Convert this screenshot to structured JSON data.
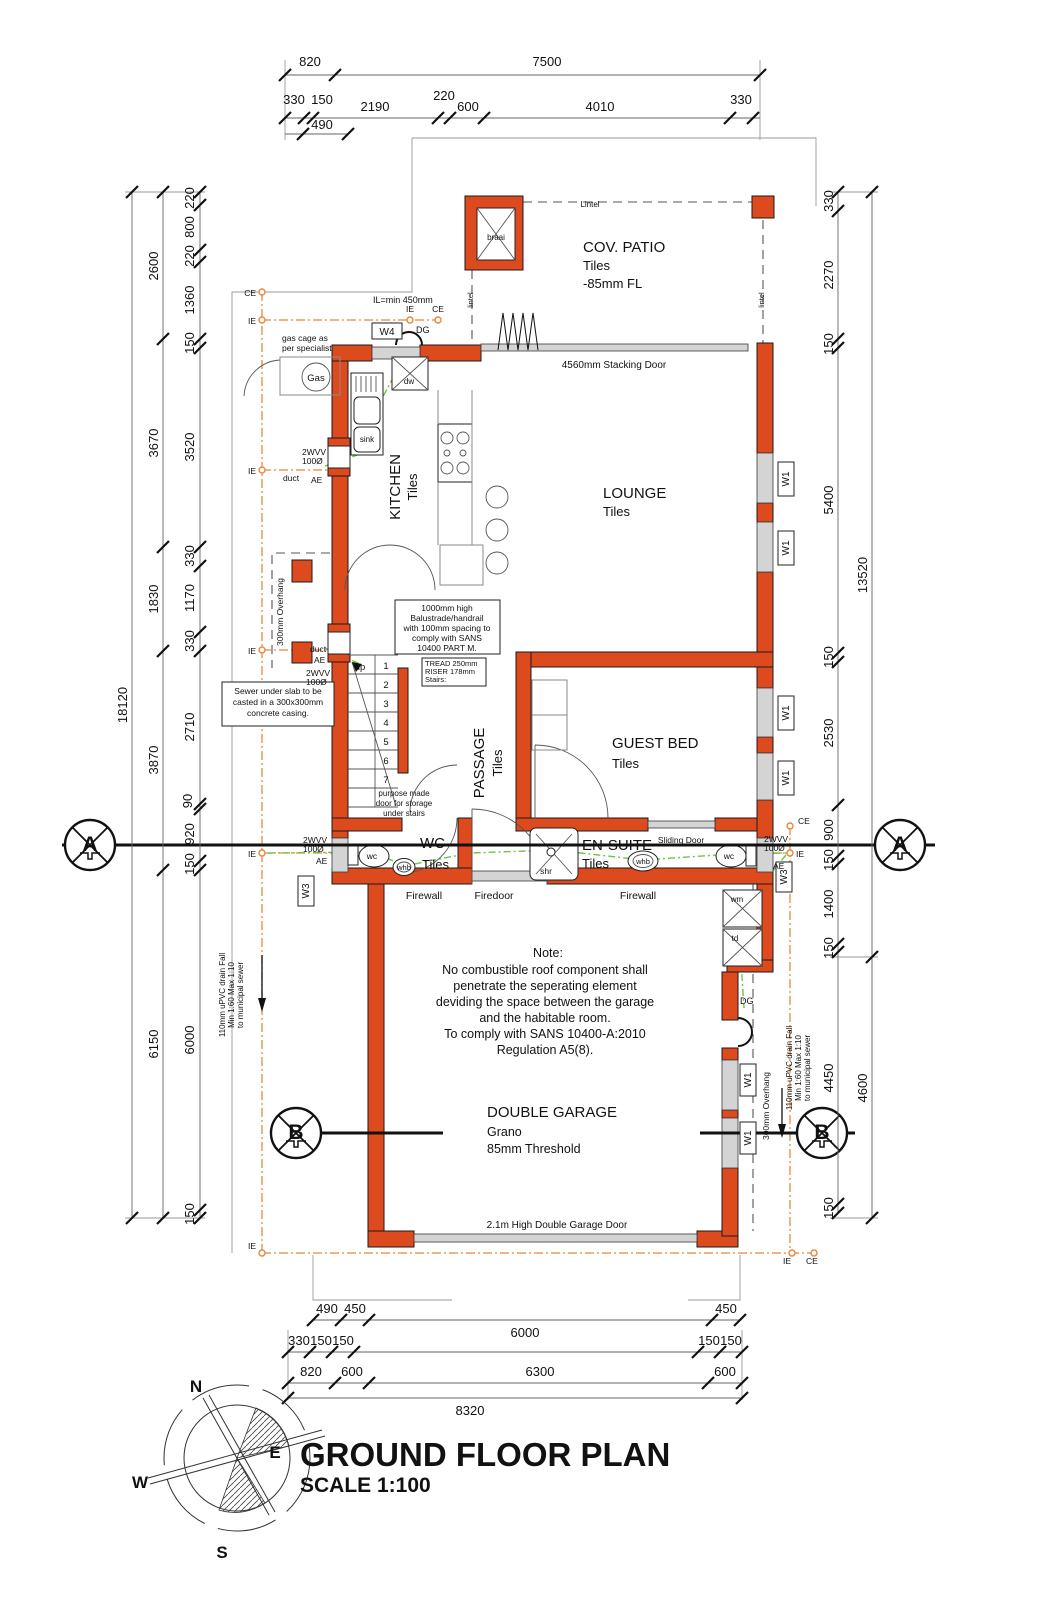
{
  "title": {
    "main": "GROUND FLOOR PLAN",
    "scale": "SCALE 1:100"
  },
  "compass": {
    "n": "N",
    "e": "E",
    "w": "W",
    "s": "S"
  },
  "rooms": {
    "patio": {
      "name": "COV. PATIO",
      "finish": "Tiles",
      "level": "-85mm FL"
    },
    "lounge": {
      "name": "LOUNGE",
      "finish": "Tiles"
    },
    "kitchen": {
      "name": "KITCHEN",
      "finish": "Tiles"
    },
    "passage": {
      "name": "PASSAGE",
      "finish": "Tiles"
    },
    "guest_bed": {
      "name": "GUEST BED",
      "finish": "Tiles"
    },
    "wc": {
      "name": "WC",
      "finish": "Tiles"
    },
    "ensuite": {
      "name": "EN-SUITE",
      "finish": "Tiles"
    },
    "garage": {
      "name": "DOUBLE GARAGE",
      "finish": "Grano",
      "threshold": "85mm Threshold"
    }
  },
  "doors": {
    "stacking": "4560mm Stacking Door",
    "garage": "2.1m High Double Garage Door",
    "sliding": "Sliding Door",
    "firewall_left": "Firewall",
    "firedoor": "Firedoor",
    "firewall_right": "Firewall"
  },
  "notes": {
    "balustrade": [
      "1000mm high",
      "Balustrade/handrail",
      "with 100mm spacing to",
      "comply with SANS",
      "10400 PART M."
    ],
    "stairs": [
      "TREAD 250mm",
      "RISER 178mm",
      "Stairs:"
    ],
    "sewer": [
      "Sewer under slab to be",
      "casted in a 300x300mm",
      "concrete casing."
    ],
    "storage": [
      "purpose made",
      "door for storage",
      "under stairs"
    ],
    "garage_title": "Note:",
    "garage_lines": [
      "No combustible roof component shall",
      "penetrate the seperating element",
      "deviding the space between the garage",
      "and the habitable room.",
      "To comply with SANS 10400-A:2010",
      "Regulation A5(8)."
    ],
    "gas": [
      "gas cage as",
      "per specialist"
    ],
    "il": "IL=min 450mm",
    "drain": [
      "110mm uPVC drain Fall",
      "Min 1:60 Max 1:10",
      "to municipal sewer"
    ],
    "overhang": "300mm Overhang",
    "lintel": "Lintel",
    "lintel_small": "lintel"
  },
  "fixtures": {
    "sink": "sink",
    "dw": "dw",
    "braai": "braai",
    "gas": "Gas",
    "wc": "wc",
    "whb": "whb",
    "shr": "shr",
    "wm": "wm",
    "td": "td",
    "up": "up",
    "stairs": [
      "1",
      "2",
      "3",
      "4",
      "5",
      "6",
      "7"
    ]
  },
  "tags": {
    "w1": "W1",
    "w3": "W3",
    "w4": "W4",
    "dg": "DG",
    "duct": "duct",
    "ae": "AE",
    "ie": "IE",
    "ce": "CE",
    "wvv": "2WVV",
    "dia": "100Ø",
    "sec_a": "A",
    "sec_b": "B"
  },
  "dims": {
    "top1": [
      "820",
      "7500"
    ],
    "top2": [
      "330",
      "150",
      "2190",
      "220",
      "600",
      "4010",
      "330"
    ],
    "top3": [
      "490"
    ],
    "bottom1": [
      "490",
      "450",
      "450"
    ],
    "bottom2": [
      "330",
      "150",
      "150",
      "6000",
      "150",
      "150"
    ],
    "bottom3": [
      "820",
      "600",
      "6300",
      "600"
    ],
    "bottom4": [
      "8320"
    ],
    "left_total": "18120",
    "left_outer": [
      "2600",
      "3670",
      "1830",
      "3870",
      "6150"
    ],
    "left_inner": [
      "220",
      "800",
      "220",
      "1360",
      "150",
      "3520",
      "330",
      "1170",
      "330",
      "2710",
      "90",
      "920",
      "150",
      "6000",
      "150"
    ],
    "right_outer": [
      "13520",
      "4600"
    ],
    "right_inner": [
      "330",
      "2270",
      "150",
      "5400",
      "150",
      "2530",
      "900",
      "150",
      "1400",
      "150",
      "4450",
      "150"
    ]
  }
}
